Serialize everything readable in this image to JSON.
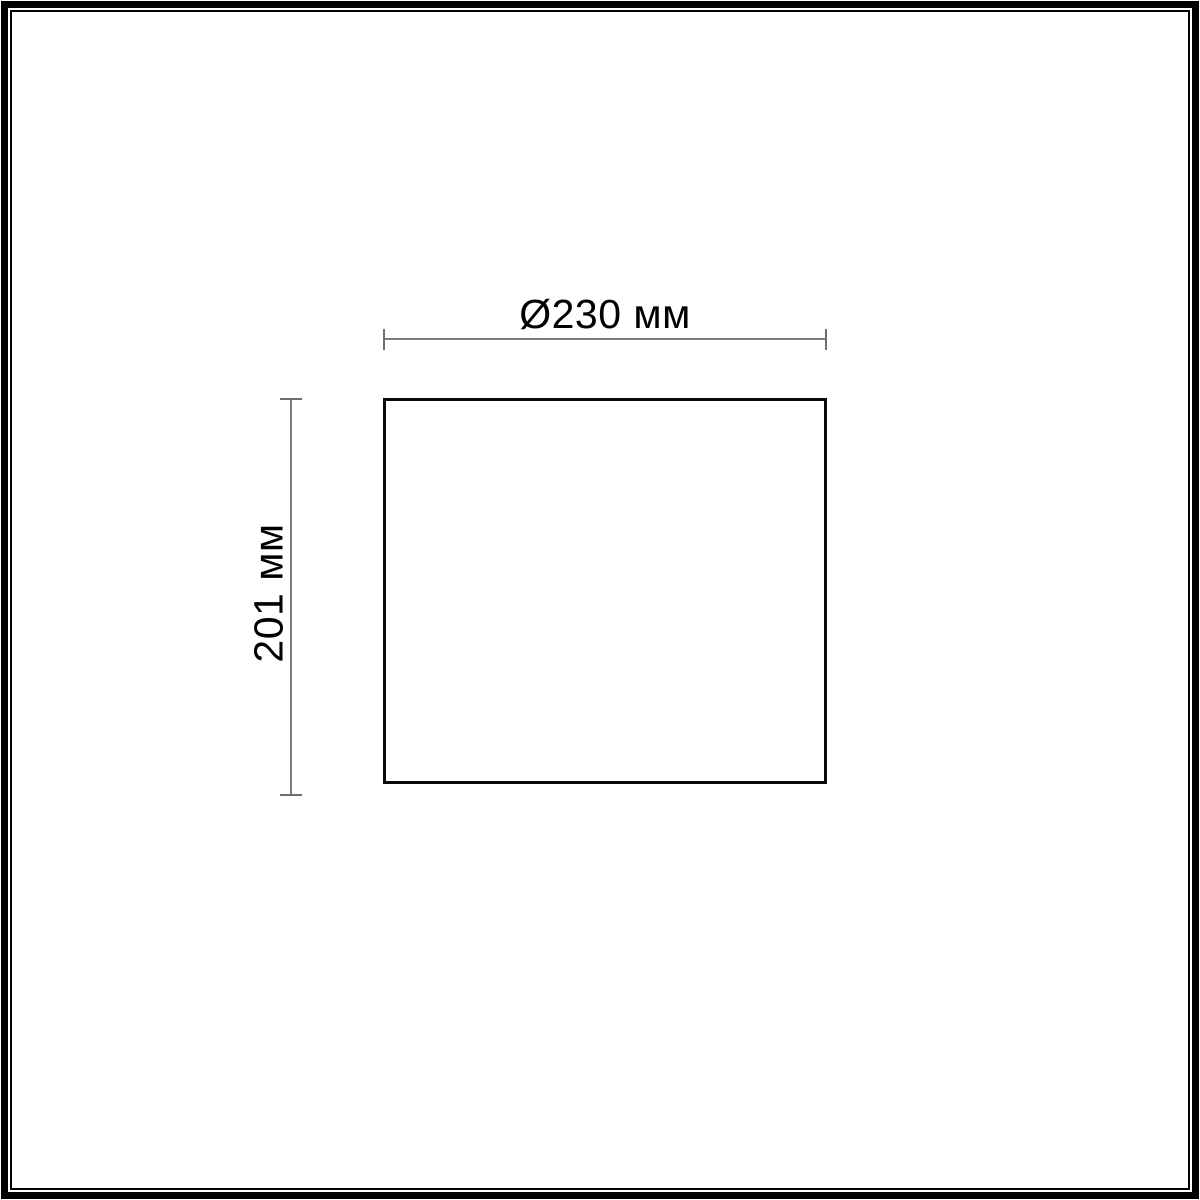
{
  "diagram": {
    "type": "product-dimension-drawing",
    "width_dimension": {
      "label": "Ø230 мм",
      "orientation": "horizontal"
    },
    "height_dimension": {
      "label": "201 мм",
      "orientation": "vertical"
    }
  },
  "colors": {
    "background": "#ffffff",
    "frame_border": "#000000",
    "outline_border": "#0a0a0a",
    "dimension_line": "#7d7d7d",
    "label_text": "#000000"
  }
}
